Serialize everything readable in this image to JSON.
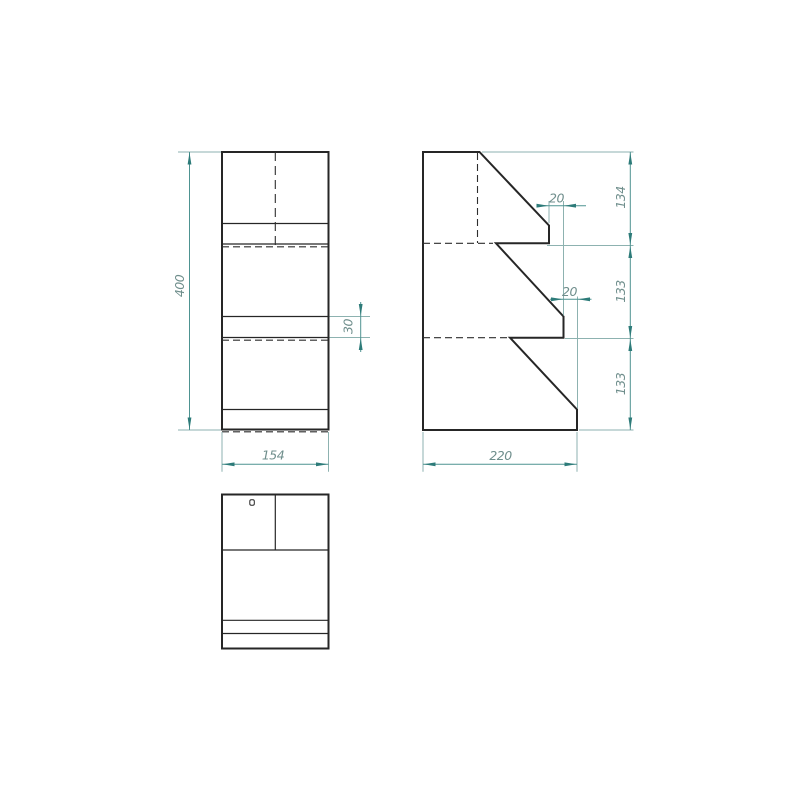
{
  "drawing": {
    "title": "three-view-technical-drawing-stepped-shelf",
    "views": {
      "front_view": {
        "dims": {
          "total_height": "400",
          "total_width": "154",
          "shelf_thickness": "30"
        }
      },
      "side_view": {
        "dims": {
          "total_depth": "220",
          "segment_top": "134",
          "segment_middle": "133",
          "segment_bottom": "133",
          "step_offset_1": "20",
          "step_offset_2": "20"
        }
      },
      "top_view": {
        "dims": {}
      }
    },
    "colors": {
      "background": "#ffffff",
      "geometry_line": "#262626",
      "hidden_line": "#2e2e2e",
      "dimension_line": "#4e9391",
      "extension_line": "#8db2b0",
      "arrow": "#2d7b79",
      "dimension_text": "#6f8e8c"
    }
  }
}
